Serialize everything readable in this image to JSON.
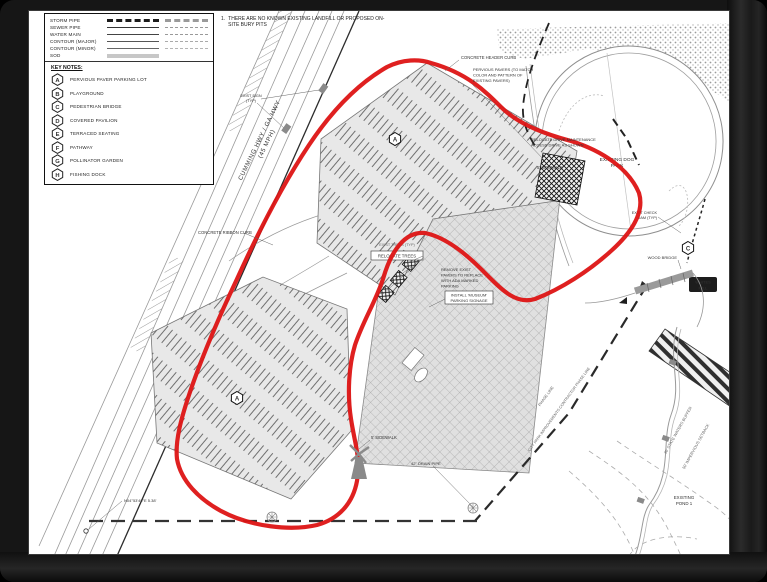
{
  "note": {
    "number": "1.",
    "text": "THERE ARE NO KNOWN EXISTING LANDFILL OR PROPOSED ON-SITE BURY PITS"
  },
  "legend": {
    "linework": [
      {
        "label": "STORM PIPE"
      },
      {
        "label": "SEWER PIPE"
      },
      {
        "label": "WATER MAIN"
      },
      {
        "label": "CONTOUR (MAJOR)"
      },
      {
        "label": "CONTOUR (MINOR)"
      },
      {
        "label": "SOD"
      }
    ],
    "key_notes_title": "KEY NOTES:",
    "key_notes": [
      {
        "id": "A",
        "label": "PERVIOUS PAVER PARKING LOT"
      },
      {
        "id": "B",
        "label": "PLAYGROUND"
      },
      {
        "id": "C",
        "label": "PEDESTRIAN BRIDGE"
      },
      {
        "id": "D",
        "label": "COVERED PAVILION"
      },
      {
        "id": "E",
        "label": "TERRACED SEATING"
      },
      {
        "id": "F",
        "label": "PATHWAY"
      },
      {
        "id": "G",
        "label": "POLLINATOR GARDEN"
      },
      {
        "id": "H",
        "label": "FISHING DOCK"
      }
    ]
  },
  "plan": {
    "colors": {
      "outline_red": "#dd1414"
    },
    "markers": {
      "a": "A",
      "c": "C"
    },
    "labels": {
      "highway": "CUMMING HWY / GA HWY",
      "speed": "(45 MPH)",
      "concrete_header_curb": "CONCRETE HEADER CURB",
      "pervious_1": "PERVIOUS PAVERS (TO MATCH",
      "pervious_2": "COLOR AND PATTERN OF",
      "pervious_3": "EXISTING PAVERS)",
      "relocate_drive_1": "RELOCATE DRIVE MAINTENANCE",
      "relocate_drive_2": "ACCESS DRIVE AS SHOWN",
      "sidewalk": "5' SIDEWALK",
      "sidewalk_bottom": "5' SIDEWALK",
      "ribbon_curb": "CONCRETE RIBBON CURB",
      "relocate_trees": "RELOCATE TREES",
      "exist_trees": "EXIST TREES (TYP)",
      "remove_1": "REMOVE EXIST",
      "remove_2": "PAVERS TO REPLACE",
      "remove_3": "WITH ADA MARKED",
      "remove_4": "PARKING",
      "museum_1": "INSTALL 'MUSEUM'",
      "museum_2": "PARKING SIGNAGE",
      "dog_park_1": "EXISTING DOG",
      "dog_park_2": "PARK",
      "pond_1": "EXISTING",
      "pond_2": "POND 1",
      "wood_bridge": "WOOD BRIDGE",
      "check_dam_1": "EXIST CHECK",
      "check_dam_2": "DAM (TYP)",
      "exist_sign_1": "EXIST SIGN",
      "exist_sign_2": "(TYP)",
      "phase_1": "PHASE LINE",
      "phase_2": "CITY PARK IMPROVEMENTS CONTRACTOR PHASE LINE",
      "waters_buffer": "30' STATE WATERS BUFFER",
      "impervious_setback": "50' IMPERVIOUS SETBACK",
      "whites_mill_1": "WHITES",
      "whites_mill_2": "MILL",
      "bearing": "N04°53'49\"E 5.38'",
      "drain_pipe": "42\" DRAIN PIPE"
    }
  }
}
